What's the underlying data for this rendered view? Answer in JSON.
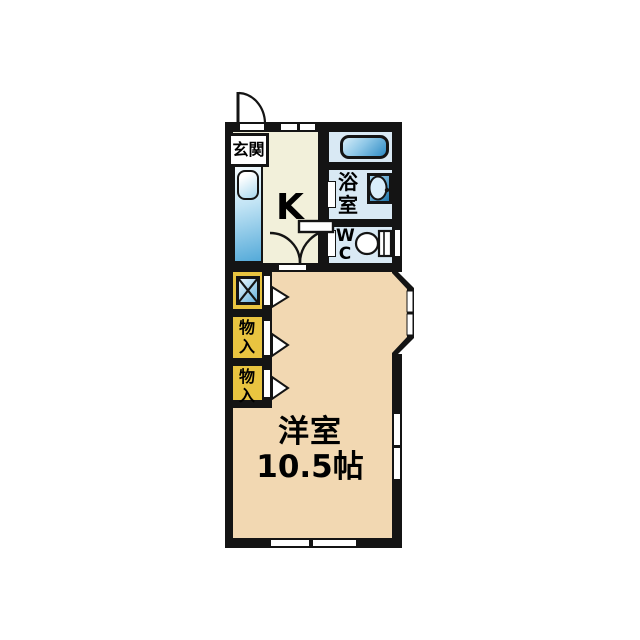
{
  "plan": {
    "type": "apartment-floor-plan",
    "rooms": {
      "genkan": {
        "label": "玄関"
      },
      "kitchen": {
        "label": "K"
      },
      "bathroom": {
        "label": "浴室"
      },
      "toilet": {
        "label": "WC"
      },
      "storage_upper": {
        "label": "物入"
      },
      "storage_lower": {
        "label": "物入"
      },
      "main": {
        "label": "洋室",
        "size": "10.5帖"
      }
    },
    "icons": {
      "entrance": "swing-door-icon",
      "kitchen_counter": "sink-counter-icon",
      "bathtub": "bathtub-icon",
      "washbasin": "washbasin-icon",
      "toilet": "toilet-icon",
      "washing_machine": "washing-machine-space-icon",
      "closet_doors": "door-swing-arrow-icon",
      "bay_window": "bay-window-icon"
    },
    "colors": {
      "wall": "#141414",
      "kitchen_floor": "#f2f0da",
      "main_floor": "#f2d8b2",
      "bath_floor": "#d9e9f4",
      "storage_fill": "#e9c440",
      "fixture_blue": "#54aad9"
    }
  }
}
